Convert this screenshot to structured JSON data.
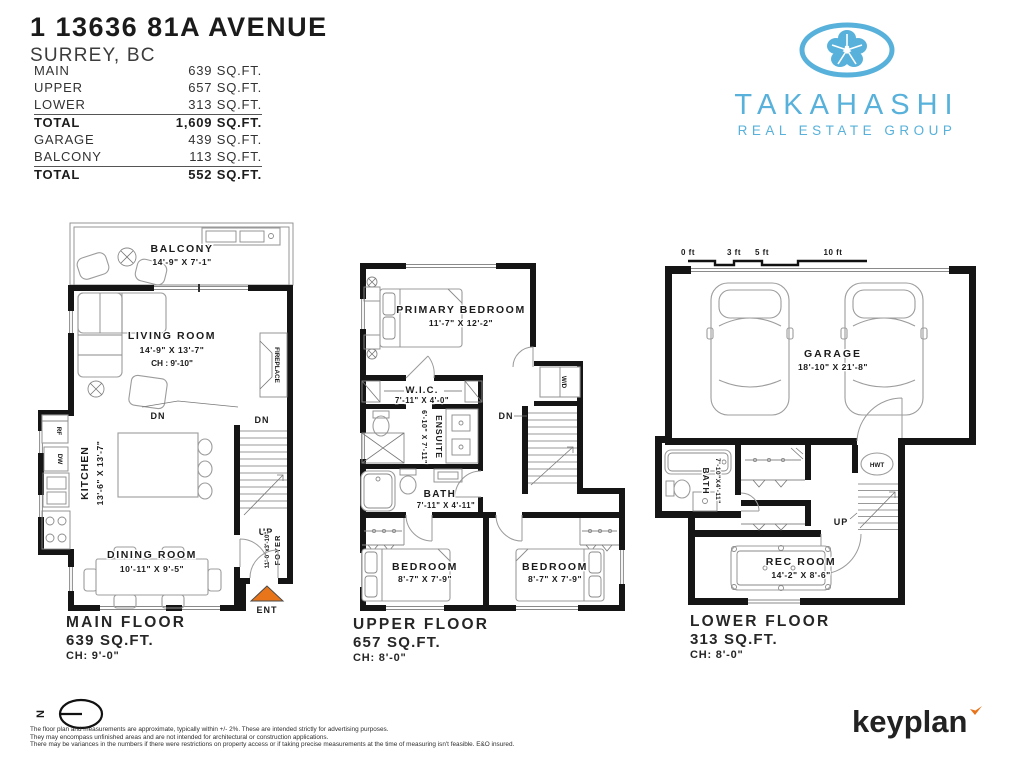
{
  "header": {
    "address": "1 13636 81A AVENUE",
    "city": "SURREY, BC"
  },
  "area_table": {
    "rows": [
      {
        "label": "MAIN",
        "value": "639 SQ.FT."
      },
      {
        "label": "UPPER",
        "value": "657 SQ.FT."
      },
      {
        "label": "LOWER",
        "value": "313 SQ.FT."
      },
      {
        "label": "TOTAL",
        "value": "1,609 SQ.FT."
      },
      {
        "label": "GARAGE",
        "value": "439 SQ.FT."
      },
      {
        "label": "BALCONY",
        "value": "113 SQ.FT."
      },
      {
        "label": "TOTAL",
        "value": "552 SQ.FT."
      }
    ]
  },
  "logo": {
    "brand": "TAKAHASHI",
    "tagline": "REAL ESTATE GROUP",
    "color": "#58B1DA"
  },
  "scale_bar": {
    "labels": [
      "0 ft",
      "3 ft",
      "5 ft",
      "10 ft"
    ]
  },
  "floors": {
    "main": {
      "title": "MAIN FLOOR",
      "area": "639 SQ.FT.",
      "ceiling": "CH: 9'-0\"",
      "balcony_name": "BALCONY",
      "balcony_dims": "14'-9\" X 7'-1\"",
      "living_name": "LIVING ROOM",
      "living_dims": "14'-9\" X 13'-7\"",
      "living_ch": "CH : 9'-10\"",
      "kitchen_name": "KITCHEN",
      "kitchen_dims": "13'-6\" X 13'-7\"",
      "dining_name": "DINING ROOM",
      "dining_dims": "10'-11\" X 9'-5\"",
      "foyer_name": "FOYER",
      "foyer_dims": "11'-0\"x3'-10\"",
      "fireplace": "FIREPLACE",
      "fridge": "RF",
      "dishwasher": "DW",
      "dn_kitchen": "DN",
      "dn_stairs": "DN",
      "up": "UP",
      "entry": "ENT"
    },
    "upper": {
      "title": "UPPER FLOOR",
      "area": "657 SQ.FT.",
      "ceiling": "CH: 8'-0\"",
      "primary_name": "PRIMARY BEDROOM",
      "primary_dims": "11'-7\" X 12'-2\"",
      "wic_name": "W.I.C.",
      "wic_dims": "7'-11\" X 4'-0\"",
      "ensuite_name": "ENSUITE",
      "ensuite_dims": "6'-10\" X 7'-11\"",
      "bath_name": "BATH",
      "bath_dims": "7'-11\" X 4'-11\"",
      "bedroom1_name": "BEDROOM",
      "bedroom1_dims": "8'-7\" X 7'-9\"",
      "bedroom2_name": "BEDROOM",
      "bedroom2_dims": "8'-7\" X 7'-9\"",
      "wd": "W/D",
      "dn": "DN"
    },
    "lower": {
      "title": "LOWER FLOOR",
      "area": "313 SQ.FT.",
      "ceiling": "CH: 8'-0\"",
      "garage_name": "GARAGE",
      "garage_dims": "18'-10\" X 21'-8\"",
      "bath_name": "BATH",
      "bath_dims": "7'-10\"X4'-11\"",
      "rec_name": "REC ROOM",
      "rec_dims": "14'-2\" X 8'-6\"",
      "hwt": "HWT",
      "up": "UP"
    }
  },
  "footer": {
    "north_label": "N",
    "disclaimer": [
      "The floor plan and measurements are approximate, typically within +/- 2%. These are intended strictly for advertising purposes.",
      "They may encompass unfinished areas and are not intended for architectural or construction applications.",
      "There may be variances in the numbers if there were restrictions on property access or if taking precise measurements at the time of measuring isn't feasible. E&O insured."
    ],
    "brand": "keyplan",
    "brand_accent": "#E8731A"
  }
}
